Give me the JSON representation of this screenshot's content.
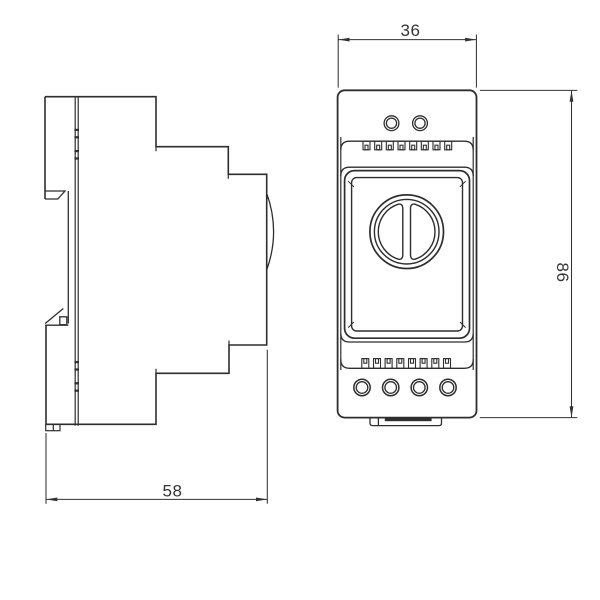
{
  "title": "Two-view technical drawing of a DIN-rail mounted device",
  "dimensions": {
    "width": "36",
    "height": "86",
    "depth": "58"
  },
  "colors": {
    "outline": "#2e2e2e",
    "dimension": "#333333",
    "background": "#ffffff"
  }
}
